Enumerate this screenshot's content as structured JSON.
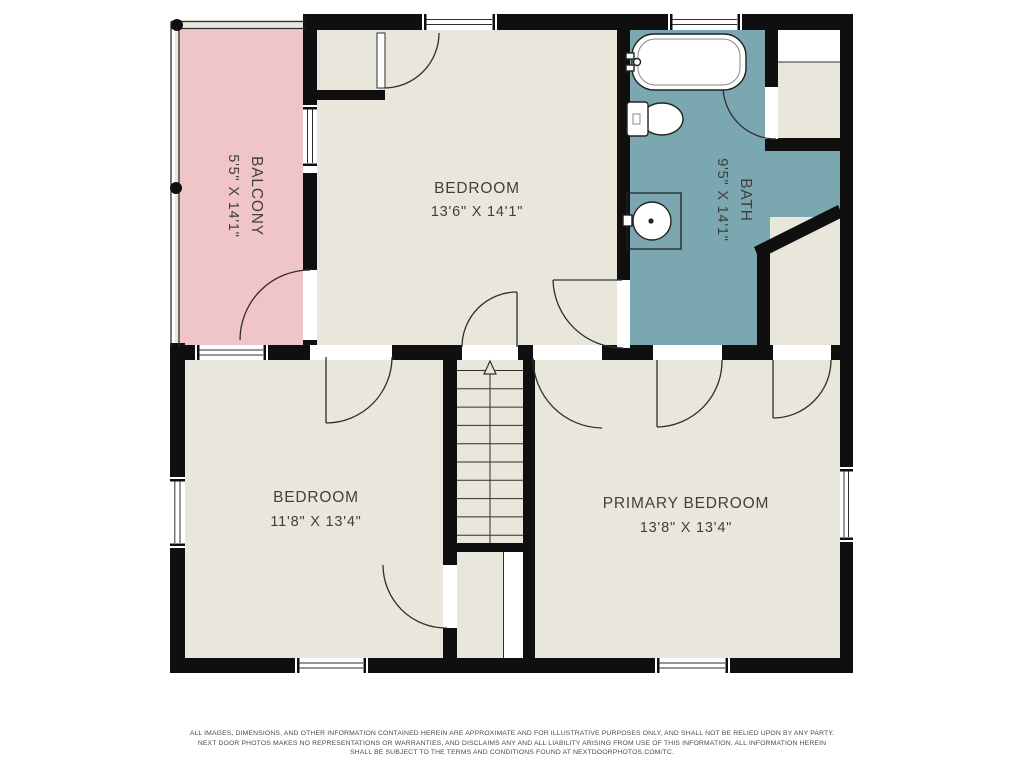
{
  "floorplan": {
    "colors": {
      "wall": "#0f0f0f",
      "floor": "#e9e7dc",
      "balcony": "#f0c5c9",
      "bath": "#7ba7b0",
      "line": "#2e2e2e",
      "label": "#3f3f3f",
      "footer": "#4a4a4a",
      "paper": "#ffffff"
    },
    "rooms": {
      "balcony": {
        "label": "BALCONY",
        "dimensions": "5'5\" X 14'1\""
      },
      "bedroom": {
        "label": "BEDROOM",
        "dimensions": "13'6\" X 14'1\""
      },
      "bath": {
        "label": "BATH",
        "dimensions": "9'5\" X 14'1\""
      },
      "bedroom2": {
        "label": "BEDROOM",
        "dimensions": "11'8\" X 13'4\""
      },
      "primary_bedroom": {
        "label": "PRIMARY BEDROOM",
        "dimensions": "13'8\" X 13'4\""
      }
    },
    "footer": {
      "line1": "ALL IMAGES, DIMENSIONS, AND OTHER INFORMATION CONTAINED HEREIN ARE APPROXIMATE AND FOR ILLUSTRATIVE PURPOSES ONLY, AND SHALL NOT BE RELIED UPON BY ANY PARTY.",
      "line2": "NEXT DOOR PHOTOS MAKES NO REPRESENTATIONS OR WARRANTIES, AND DISCLAIMS ANY AND ALL LIABILITY ARISING FROM USE OF THIS INFORMATION. ALL INFORMATION HEREIN",
      "line3": "SHALL BE SUBJECT TO THE TERMS AND CONDITIONS FOUND AT NEXTDOORPHOTOS.COM/TC."
    }
  }
}
